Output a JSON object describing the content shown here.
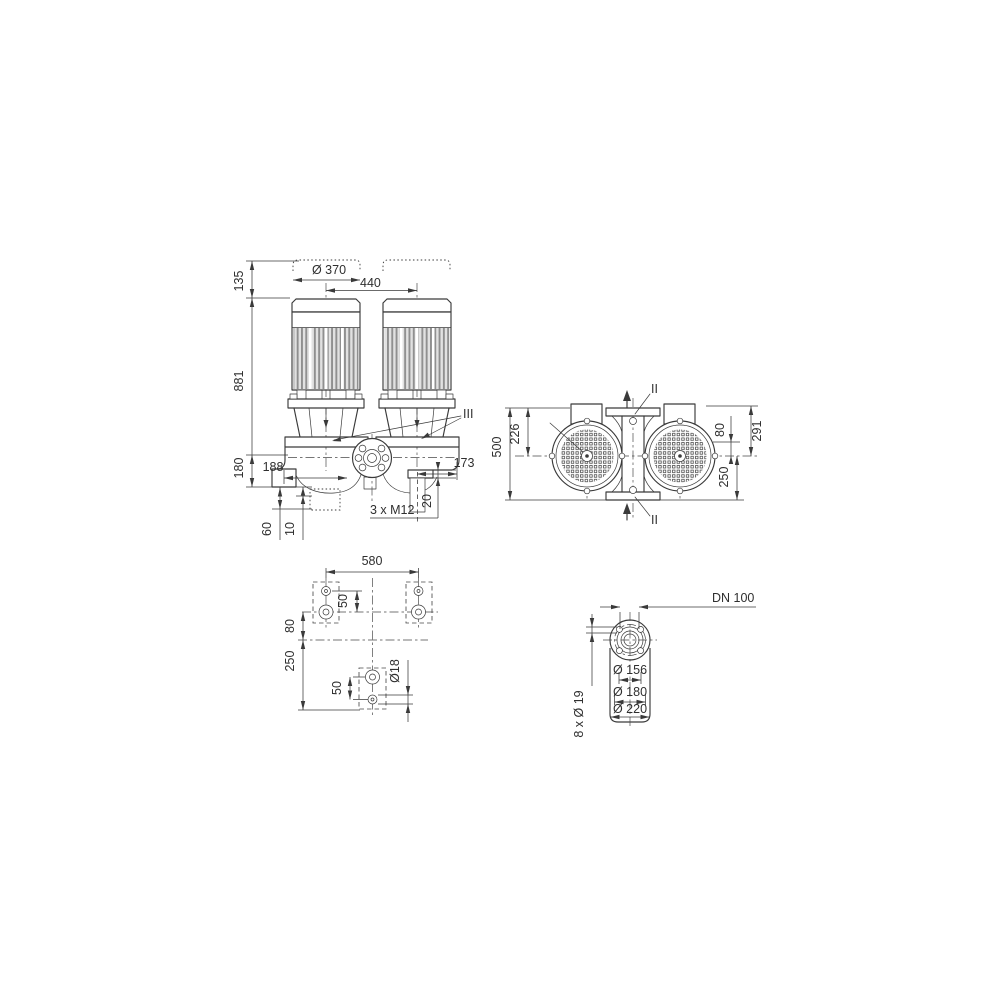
{
  "drawing": {
    "background": "#ffffff",
    "ink_color": "#3a3a3a",
    "views": {
      "front_elevation": {
        "dims": {
          "fan_cover_clearance": "135",
          "overall_height": "881",
          "base_to_axis": "180",
          "axis_offset_left": "188",
          "axis_offset_right": "173",
          "motor_diameter": "Ø 370",
          "motor_spacing": "440",
          "foundation_depth": "60",
          "grout_offset": "10",
          "foot_plate_thickness": "20",
          "tapped_holes": "3 x M12",
          "seal_section_callout": "III"
        }
      },
      "top_view": {
        "dims": {
          "port_to_port": "500",
          "flange_to_axis": "226",
          "axis_to_branch": "80",
          "upper_span": "291",
          "axis_to_flange": "250",
          "section_upper": "II",
          "section_lower": "II"
        }
      },
      "foundation_plan": {
        "dims": {
          "anchor_spacing": "580",
          "upper_hole_pitch": "50",
          "axis_to_row": "80",
          "row_spacing": "250",
          "lower_hole_pitch": "50",
          "anchor_hole_diameter": "Ø18"
        }
      },
      "flange_detail": {
        "dims": {
          "nominal_diameter": "DN 100",
          "raised_face": "Ø 156",
          "bolt_circle": "Ø 180",
          "flange_od": "Ø 220",
          "bolt_holes": "8 x Ø 19"
        }
      }
    }
  }
}
